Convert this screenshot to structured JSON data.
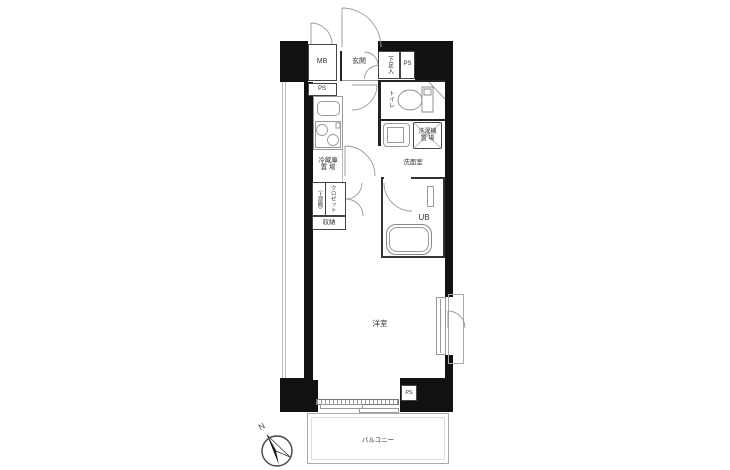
{
  "floor_plan": {
    "labels": {
      "meter_box": "MB",
      "pipe_space_top": "PS",
      "pipe_space_kitchen": "PS",
      "pipe_space_bottom": "PS",
      "entrance": "玄関",
      "shoe_cabinet": "下足入",
      "toilet": "トイレ",
      "fridge_space_line1": "冷蔵庫",
      "fridge_space_line2": "置 場",
      "washer_space_line1": "洗濯機",
      "washer_space_line2": "置 場",
      "washroom": "洗面室",
      "closet_shelf": "（上部棚）",
      "closet": "クロゼット",
      "storage": "収納",
      "unit_bath": "UB",
      "western_room": "洋室",
      "balcony": "バルコニー",
      "compass_north": "N"
    },
    "colors": {
      "wall": "#111111",
      "line_dark": "#333333",
      "line_light": "#999999",
      "text": "#333333",
      "background": "#ffffff"
    }
  }
}
